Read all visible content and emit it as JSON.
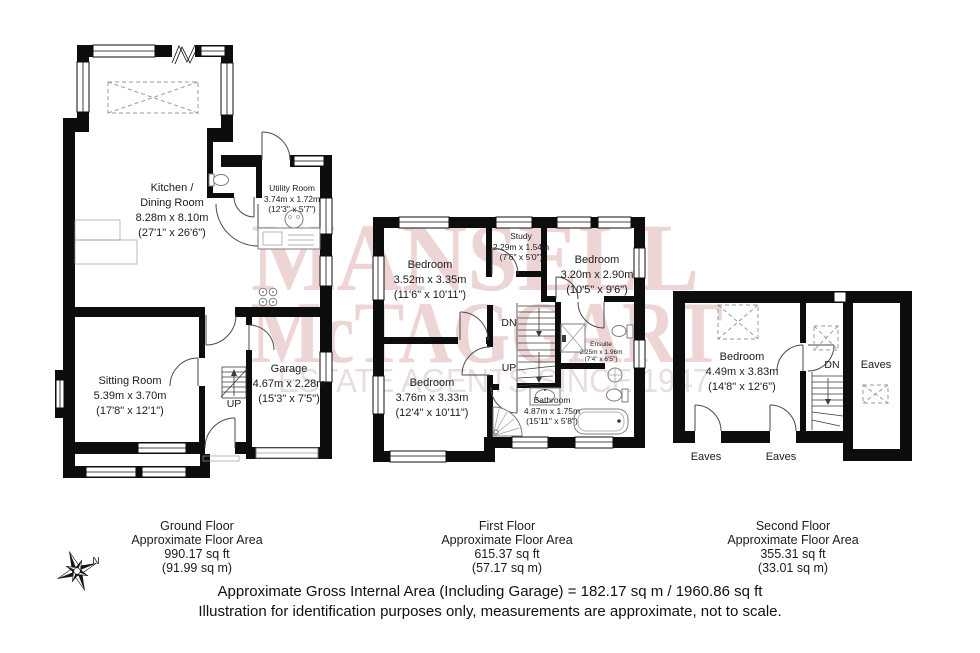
{
  "watermark": {
    "line1": "MANSELL",
    "line2": "McTAGGART",
    "line3": "ESTATE AGENTS SINCE 1947",
    "color": "#eed5d5",
    "sub_color": "#e9dede"
  },
  "colors": {
    "wall": "#0d0d0d",
    "background": "#ffffff"
  },
  "floors": [
    {
      "id": "ground",
      "caption": [
        "Ground Floor",
        "Approximate Floor Area",
        "990.17 sq ft",
        "(91.99 sq m)"
      ],
      "rooms": [
        {
          "key": "kitchen-dining",
          "lines": [
            "Kitchen /",
            "Dining Room",
            "8.28m x 8.10m",
            "(27'1\" x 26'6\")"
          ]
        },
        {
          "key": "utility",
          "lines": [
            "Utility Room",
            "3.74m x 1.72m",
            "(12'3\" x 5'7\")"
          ]
        },
        {
          "key": "sitting",
          "lines": [
            "Sitting Room",
            "5.39m x 3.70m",
            "(17'8\" x 12'1\")"
          ]
        },
        {
          "key": "garage",
          "lines": [
            "Garage",
            "4.67m x 2.28m",
            "(15'3\" x 7'5\")"
          ]
        }
      ],
      "stairs_label": "UP"
    },
    {
      "id": "first",
      "caption": [
        "First Floor",
        "Approximate Floor Area",
        "615.37 sq ft",
        "(57.17 sq m)"
      ],
      "rooms": [
        {
          "key": "bedroom-1",
          "lines": [
            "Bedroom",
            "3.52m x 3.35m",
            "(11'6\" x 10'11\")"
          ]
        },
        {
          "key": "study",
          "lines": [
            "Study",
            "2.29m x 1.54m",
            "(7'6\" x 5'0\")"
          ]
        },
        {
          "key": "bedroom-2",
          "lines": [
            "Bedroom",
            "3.20m x 2.90m",
            "(10'5\" x 9'6\")"
          ]
        },
        {
          "key": "bedroom-3",
          "lines": [
            "Bedroom",
            "3.76m x 3.33m",
            "(12'4\" x 10'11\")"
          ]
        },
        {
          "key": "ensuite",
          "lines": [
            "Ensuite",
            "2.25m x 1.96m",
            "(7'4\" x 6'5\")"
          ]
        },
        {
          "key": "bathroom",
          "lines": [
            "Bathroom",
            "4.87m x 1.75m",
            "(15'11\" x 5'8\")"
          ]
        }
      ],
      "stairs_labels": {
        "dn": "DN",
        "up": "UP"
      }
    },
    {
      "id": "second",
      "caption": [
        "Second Floor",
        "Approximate Floor Area",
        "355.31 sq ft",
        "(33.01 sq m)"
      ],
      "rooms": [
        {
          "key": "bedroom-4",
          "lines": [
            "Bedroom",
            "4.49m x 3.83m",
            "(14'8\" x 12'6\")"
          ]
        }
      ],
      "eaves_labels": [
        "Eaves",
        "Eaves",
        "Eaves"
      ],
      "stairs_label": "DN"
    }
  ],
  "compass": {
    "north_label": "N"
  },
  "footer": {
    "line1": "Approximate Gross Internal Area (Including Garage) = 182.17 sq m / 1960.86 sq ft",
    "line2": "Illustration for identification purposes only, measurements are approximate, not to scale."
  }
}
